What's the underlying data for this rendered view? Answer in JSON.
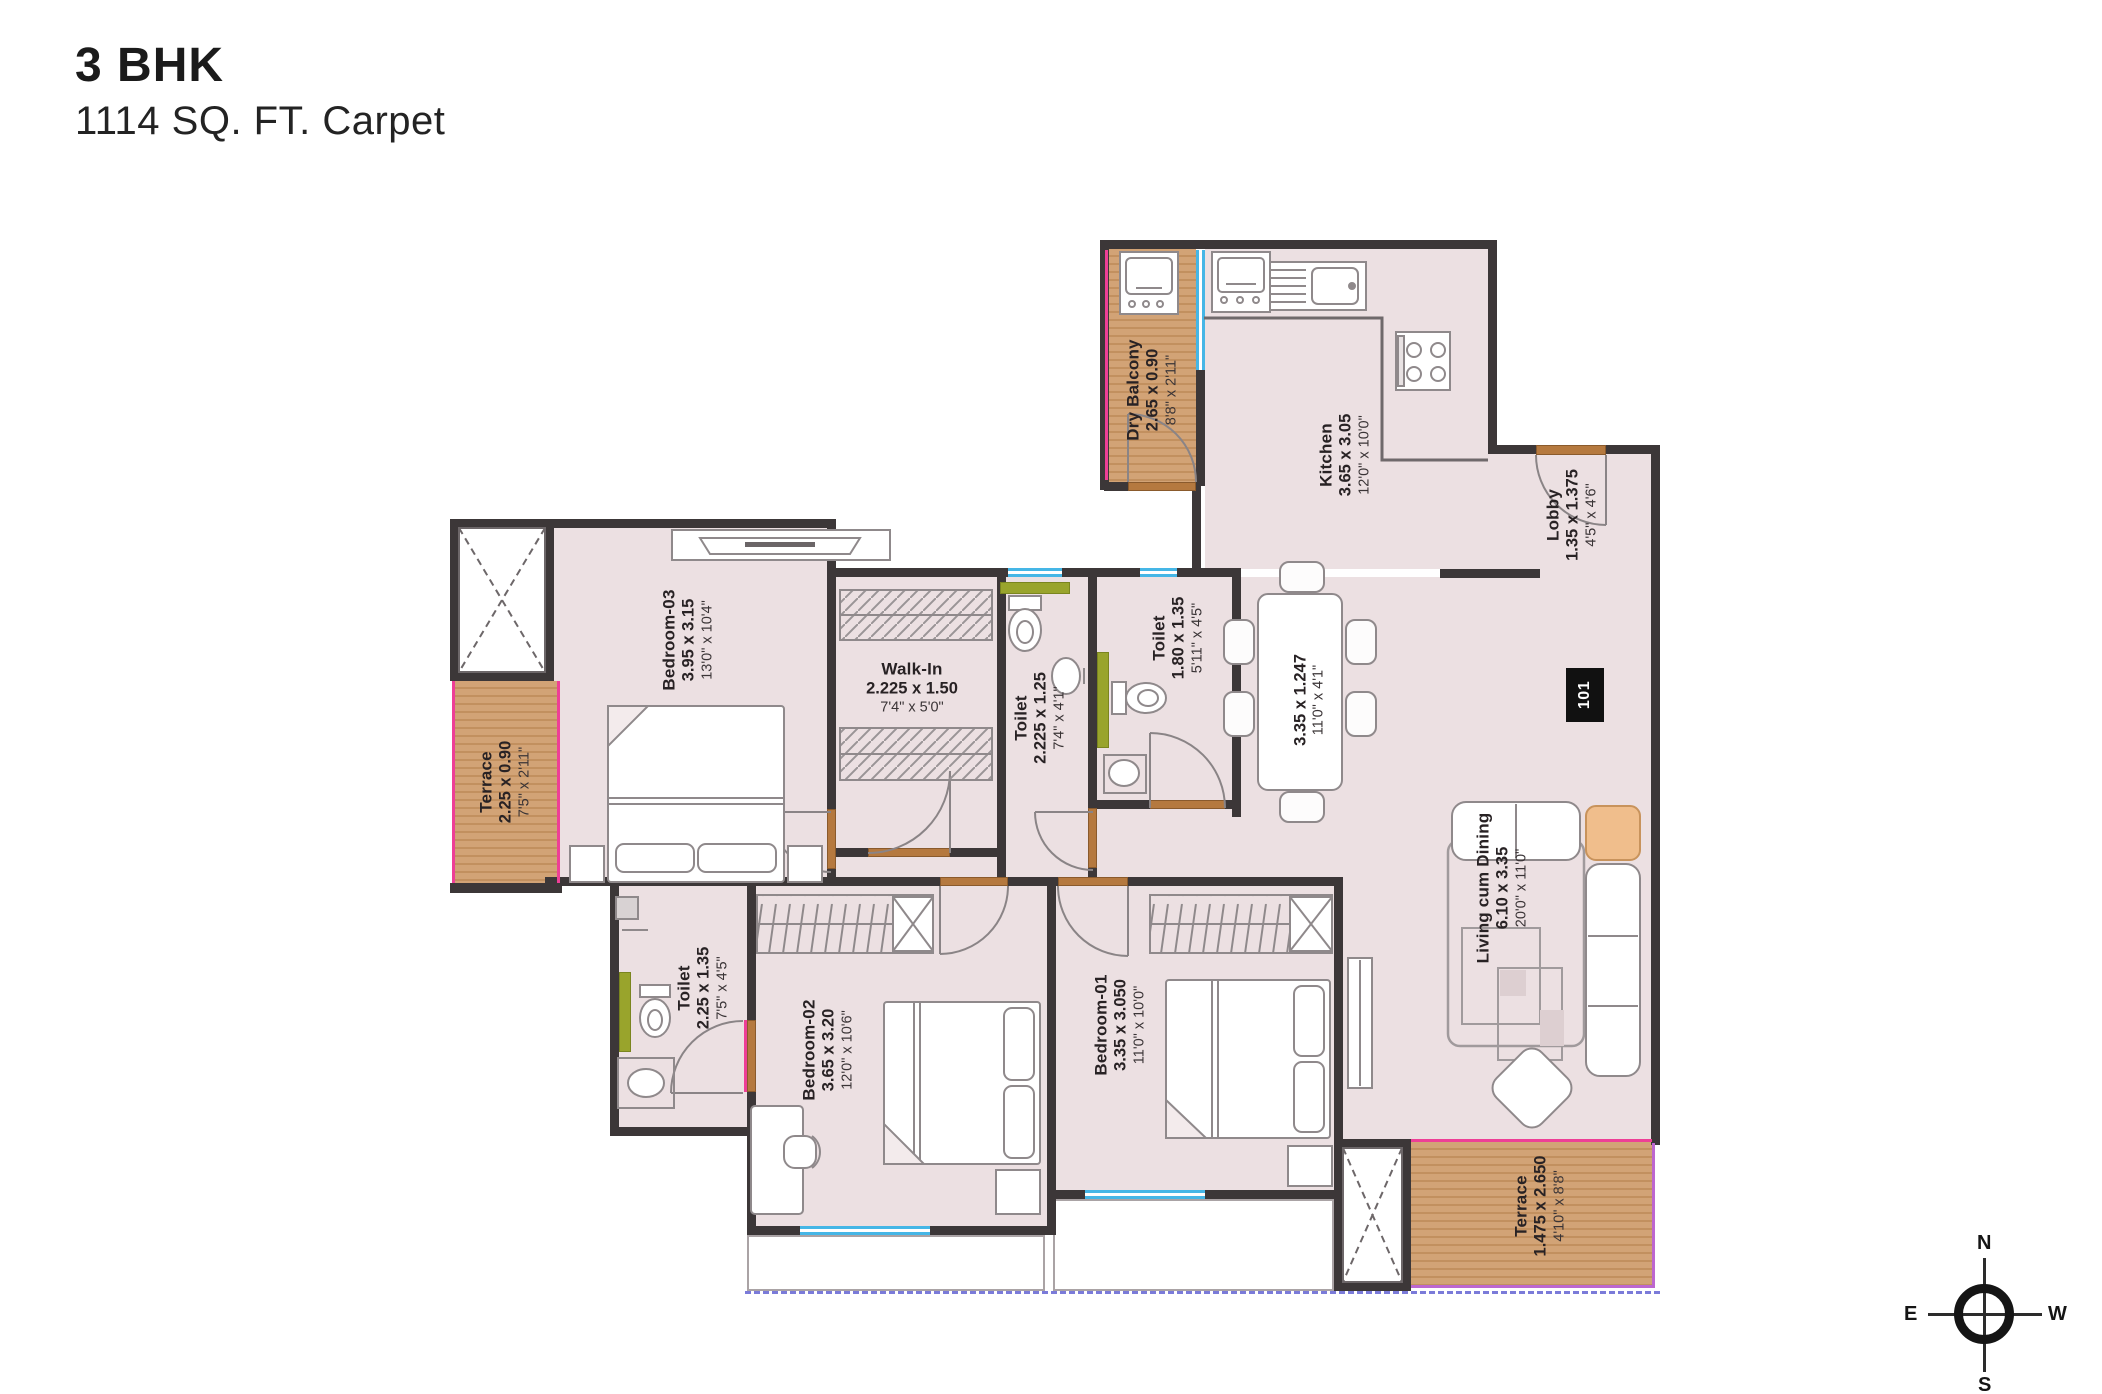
{
  "title": {
    "line1": "3 BHK",
    "line2": "1114 SQ. FT. Carpet"
  },
  "unit_number": "101",
  "compass": {
    "north": "N",
    "south": "S",
    "east": "E",
    "west": "W"
  },
  "rooms": {
    "dry_balcony": {
      "name": "Dry Balcony",
      "dim_m": "2.65 x 0.90",
      "dim_ft": "8'8\" x 2'11\""
    },
    "kitchen": {
      "name": "Kitchen",
      "dim_m": "3.65 x 3.05",
      "dim_ft": "12'0\" x 10'0\""
    },
    "lobby": {
      "name": "Lobby",
      "dim_m": "1.35 x 1.375",
      "dim_ft": "4'5\" x 4'6\""
    },
    "bedroom_03": {
      "name": "Bedroom-03",
      "dim_m": "3.95 x 3.15",
      "dim_ft": "13'0\" x 10'4\""
    },
    "terrace_left": {
      "name": "Terrace",
      "dim_m": "2.25 x 0.90",
      "dim_ft": "7'5\" x 2'11\""
    },
    "walk_in": {
      "name": "Walk-In",
      "dim_m": "2.225 x 1.50",
      "dim_ft": "7'4\" x 5'0\""
    },
    "toilet_walk_in": {
      "name": "Toilet",
      "dim_m": "2.225 x 1.25",
      "dim_ft": "7'4\" x 4'1\""
    },
    "toilet_common": {
      "name": "Toilet",
      "dim_m": "1.80 x 1.35",
      "dim_ft": "5'11\" x 4'5\""
    },
    "dining": {
      "dim_m": "3.35 x 1.247",
      "dim_ft": "11'0\" x 4'1\""
    },
    "living_cum_dining": {
      "name": "Living cum Dining",
      "dim_m": "6.10 x 3.35",
      "dim_ft": "20'0\" x 11'0\""
    },
    "toilet_bedroom_02": {
      "name": "Toilet",
      "dim_m": "2.25 x 1.35",
      "dim_ft": "7'5\" x 4'5\""
    },
    "bedroom_02": {
      "name": "Bedroom-02",
      "dim_m": "3.65 x 3.20",
      "dim_ft": "12'0\" x 10'6\""
    },
    "bedroom_01": {
      "name": "Bedroom-01",
      "dim_m": "3.35 x 3.050",
      "dim_ft": "11'0\" x 10'0\""
    },
    "terrace_bottom": {
      "name": "Terrace",
      "dim_m": "1.475 x 2.650",
      "dim_ft": "4'10\" x 8'8\""
    }
  },
  "colors": {
    "floor": "#ece0e2",
    "wall": "#3c3738",
    "wood_deck": "#d2a376",
    "window": "#45b6e6",
    "shower_strip": "#99a42c",
    "accent_pink": "#ee3f96",
    "accent_purple": "#bd67cf",
    "door": "#b5793f",
    "setback_dash": "#7b7bd9",
    "furniture_orange": "#f0be8c"
  }
}
